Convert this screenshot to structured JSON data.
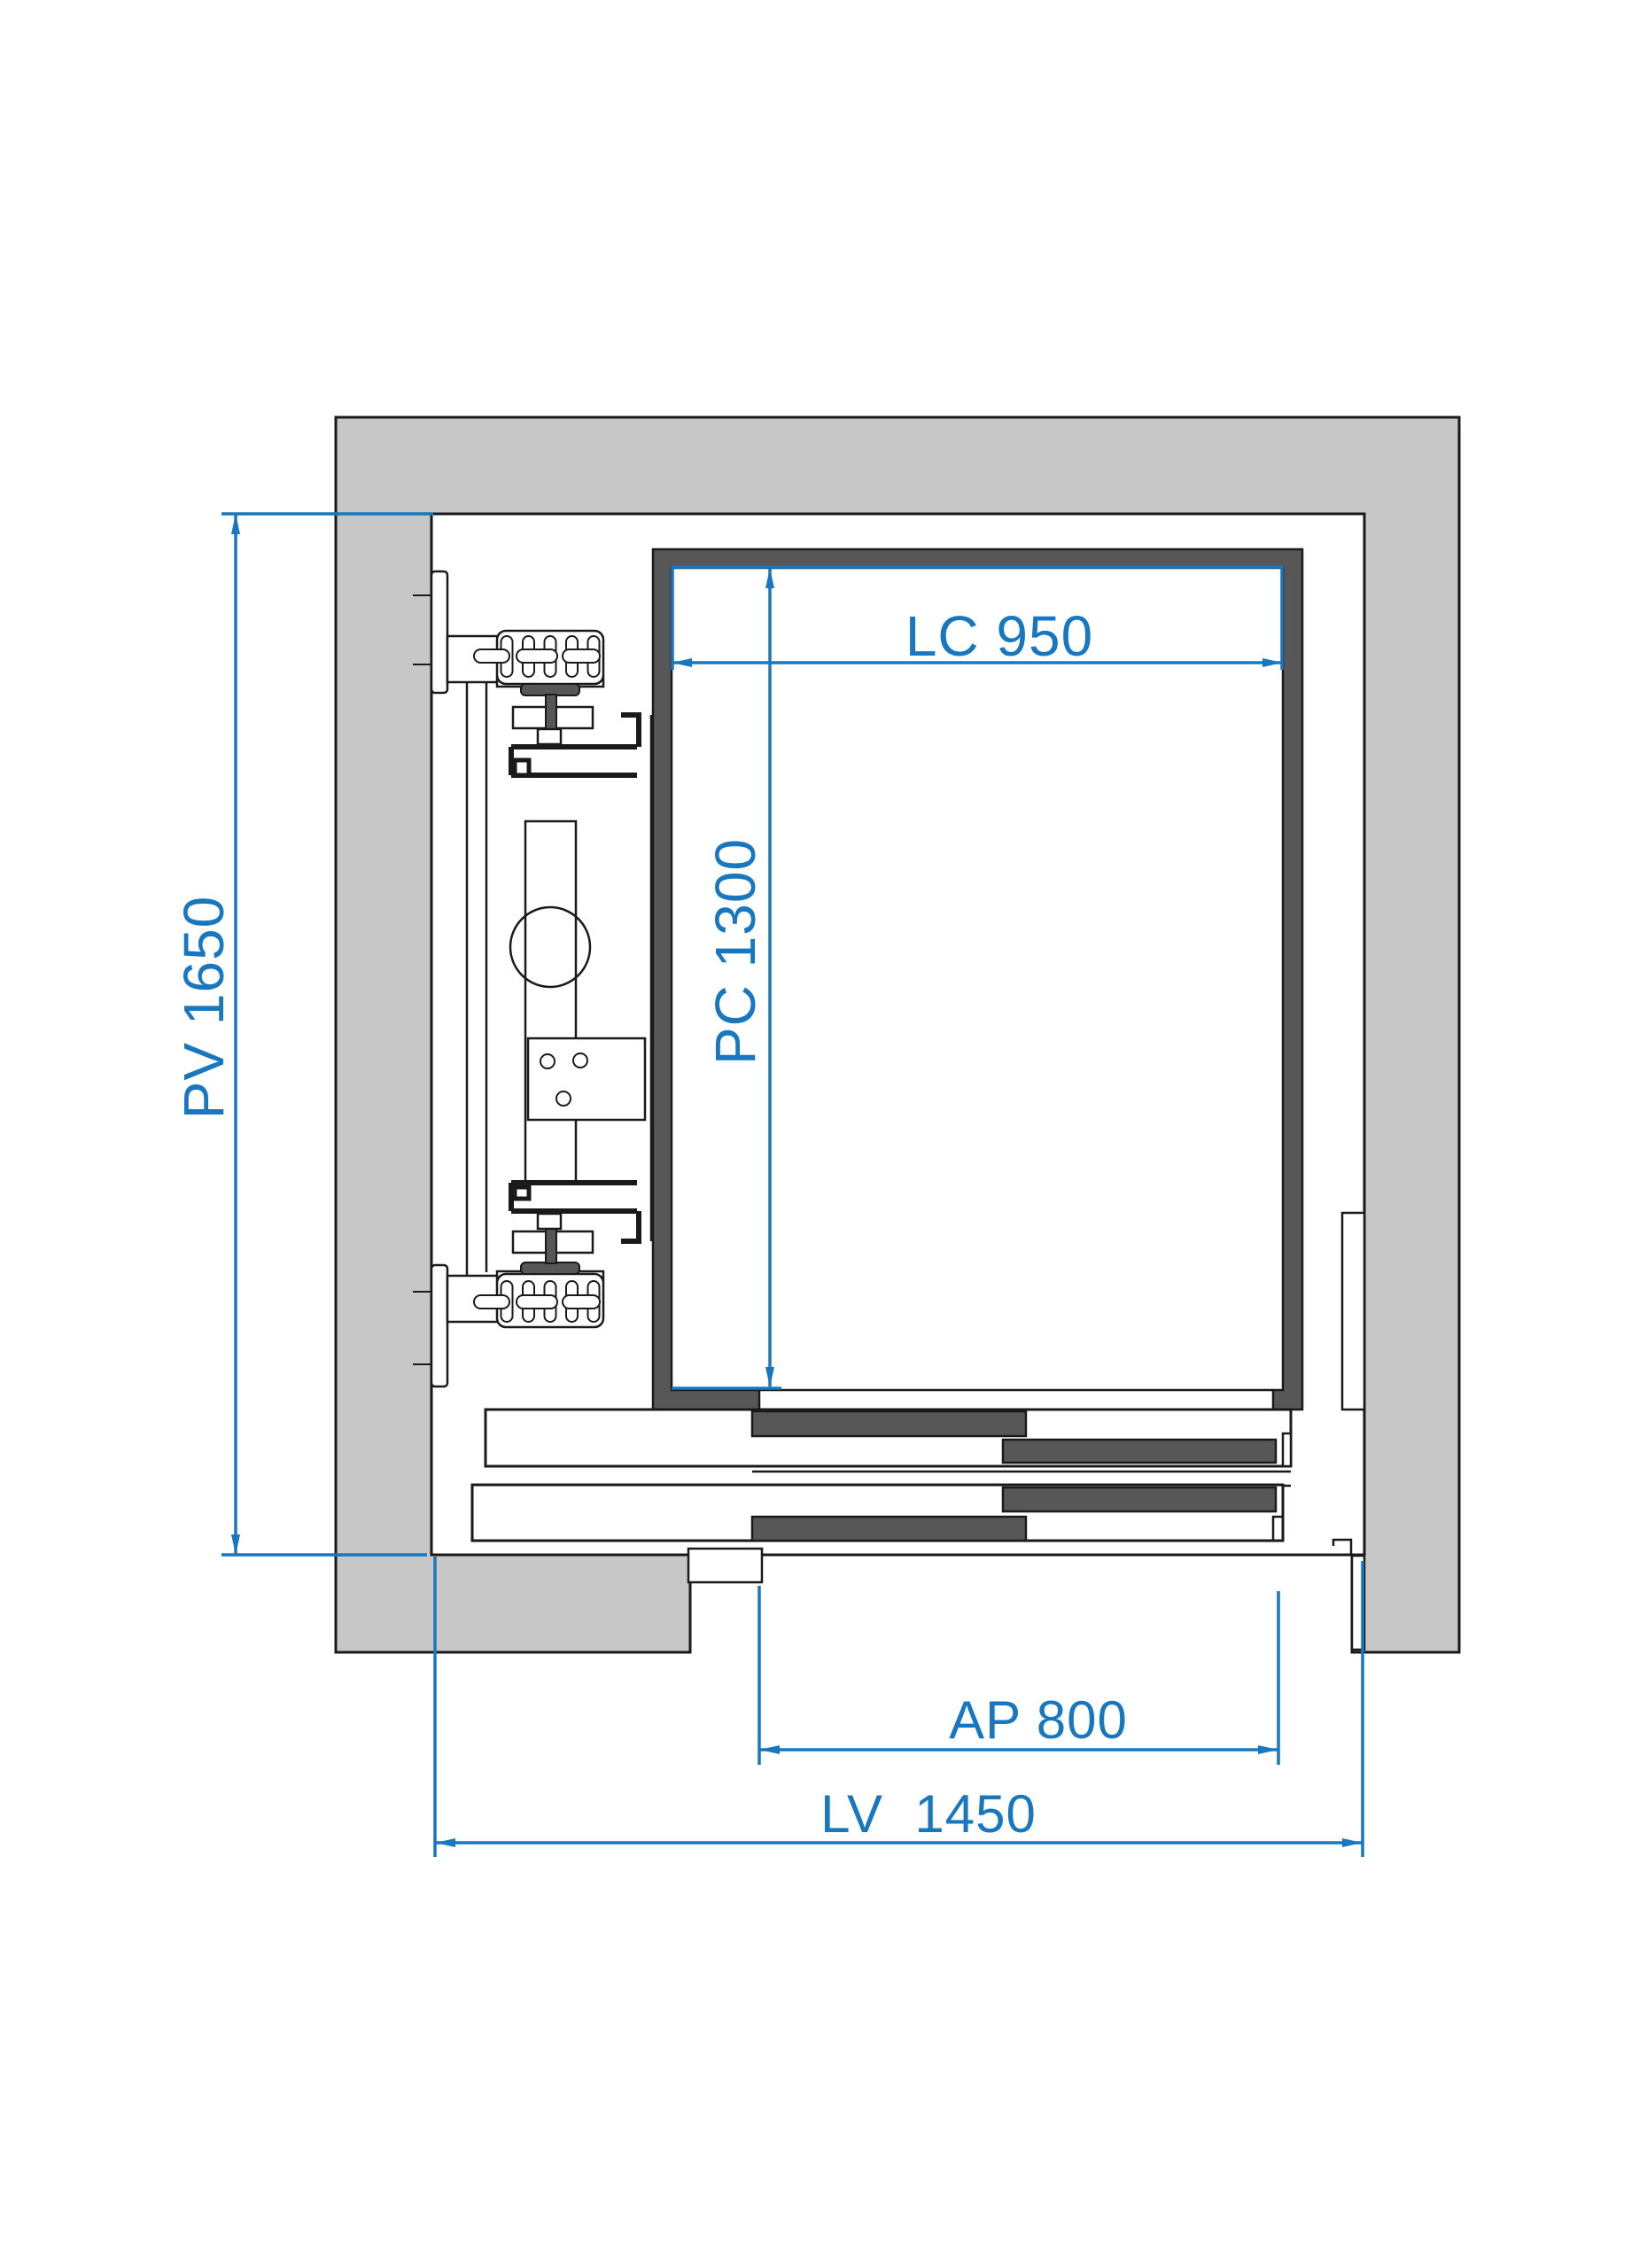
{
  "drawing": {
    "kind": "elevator-shaft-plan-section",
    "colors": {
      "background": "#ffffff",
      "wall_fill": "#c7c7c7",
      "cabin_fill": "#575757",
      "panel_fill": "#575757",
      "outline": "#1a1a1a",
      "dimension": "#1877be"
    },
    "dimensions": {
      "pv": {
        "label": "PV 1650",
        "orientation": "vertical",
        "side": "left"
      },
      "lc": {
        "label": "LC 950",
        "orientation": "horizontal",
        "side": "cabin-top"
      },
      "pc": {
        "label": "PC 1300",
        "orientation": "vertical",
        "side": "cabin-left"
      },
      "ap": {
        "label": "AP 800",
        "orientation": "horizontal",
        "side": "bottom"
      },
      "lv": {
        "label": "LV  1450",
        "orientation": "horizontal",
        "side": "bottom"
      }
    }
  }
}
